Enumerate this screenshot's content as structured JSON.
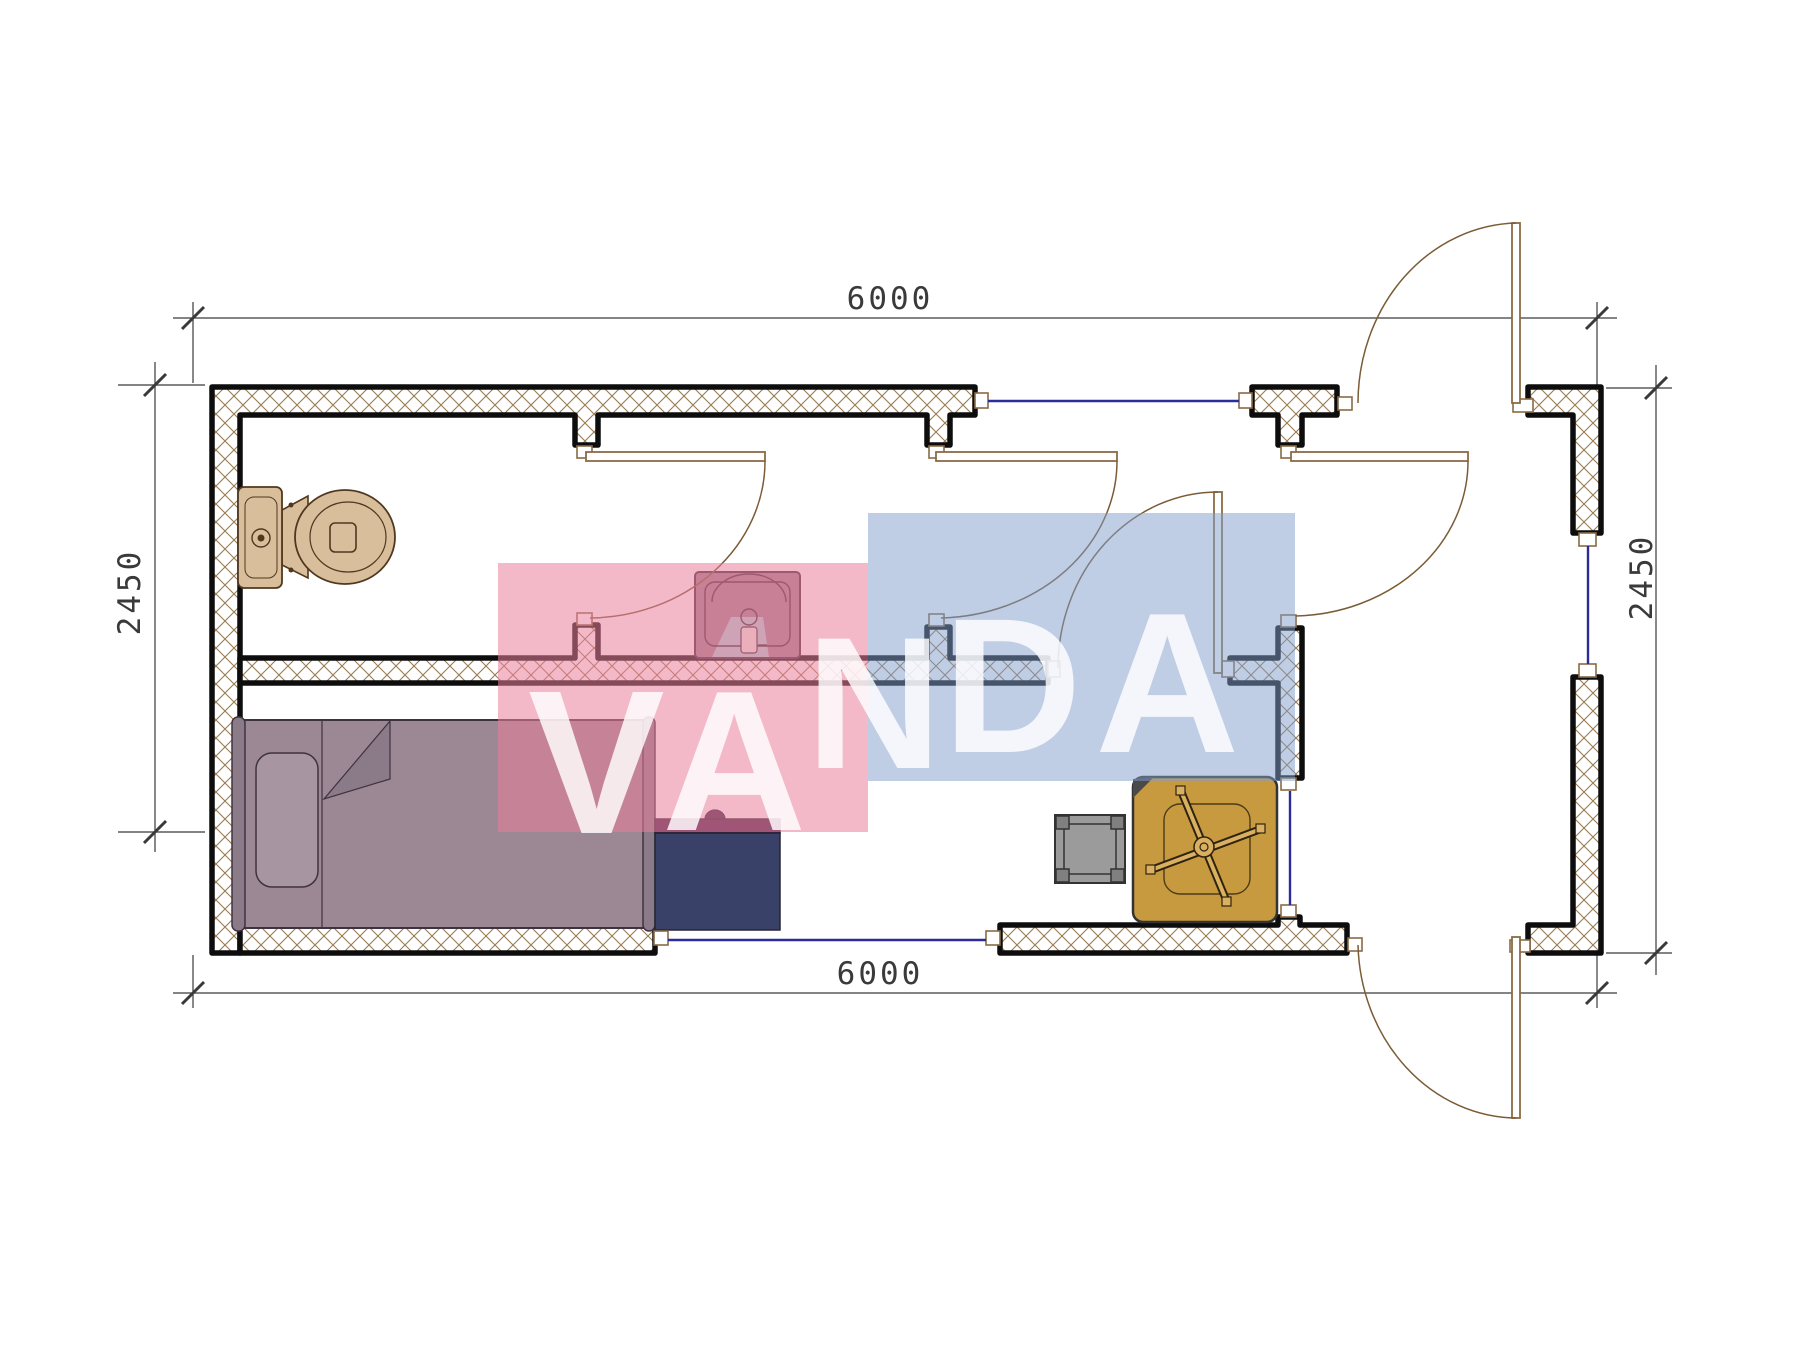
{
  "dimensions": {
    "top": "6000",
    "bottom": "6000",
    "left": "2450",
    "right": "2450"
  },
  "watermark": {
    "word": "VANDA",
    "letters": [
      "V",
      "A",
      "N",
      "D",
      "A"
    ]
  },
  "colors": {
    "wall_hatch": "#9a7b50",
    "wall_outline": "#0d0d0d",
    "door_line": "#8a6b45",
    "door_arc": "#7a5c35",
    "window_line": "#2b2b9a",
    "dim_line": "#3a3a3a",
    "dim_text": "#3a3a3a",
    "toilet": "#d9be9c",
    "toilet_outline": "#50381f",
    "sink": "#9e8291",
    "sink_outline": "#3f2a3a",
    "sink_mat": "#aecfd8",
    "bed": "#9c8894",
    "bed_alt": "#8b7a88",
    "bed_pillow": "#a795a2",
    "bed_outline": "#3f3240",
    "desk": "#3a4168",
    "desk_top": "#47224a",
    "desk_outline": "#262636",
    "stool": "#9b9b9b",
    "stool_dark": "#808080",
    "stool_outline": "#333333",
    "table": "#c89a3f",
    "table_light": "#d8b05f",
    "table_dark": "#2f2310",
    "watermark_pink": "rgba(233,128,154,0.55)",
    "watermark_blue": "rgba(128,158,204,0.50)",
    "watermark_text": "rgba(255,255,255,0.82)"
  }
}
